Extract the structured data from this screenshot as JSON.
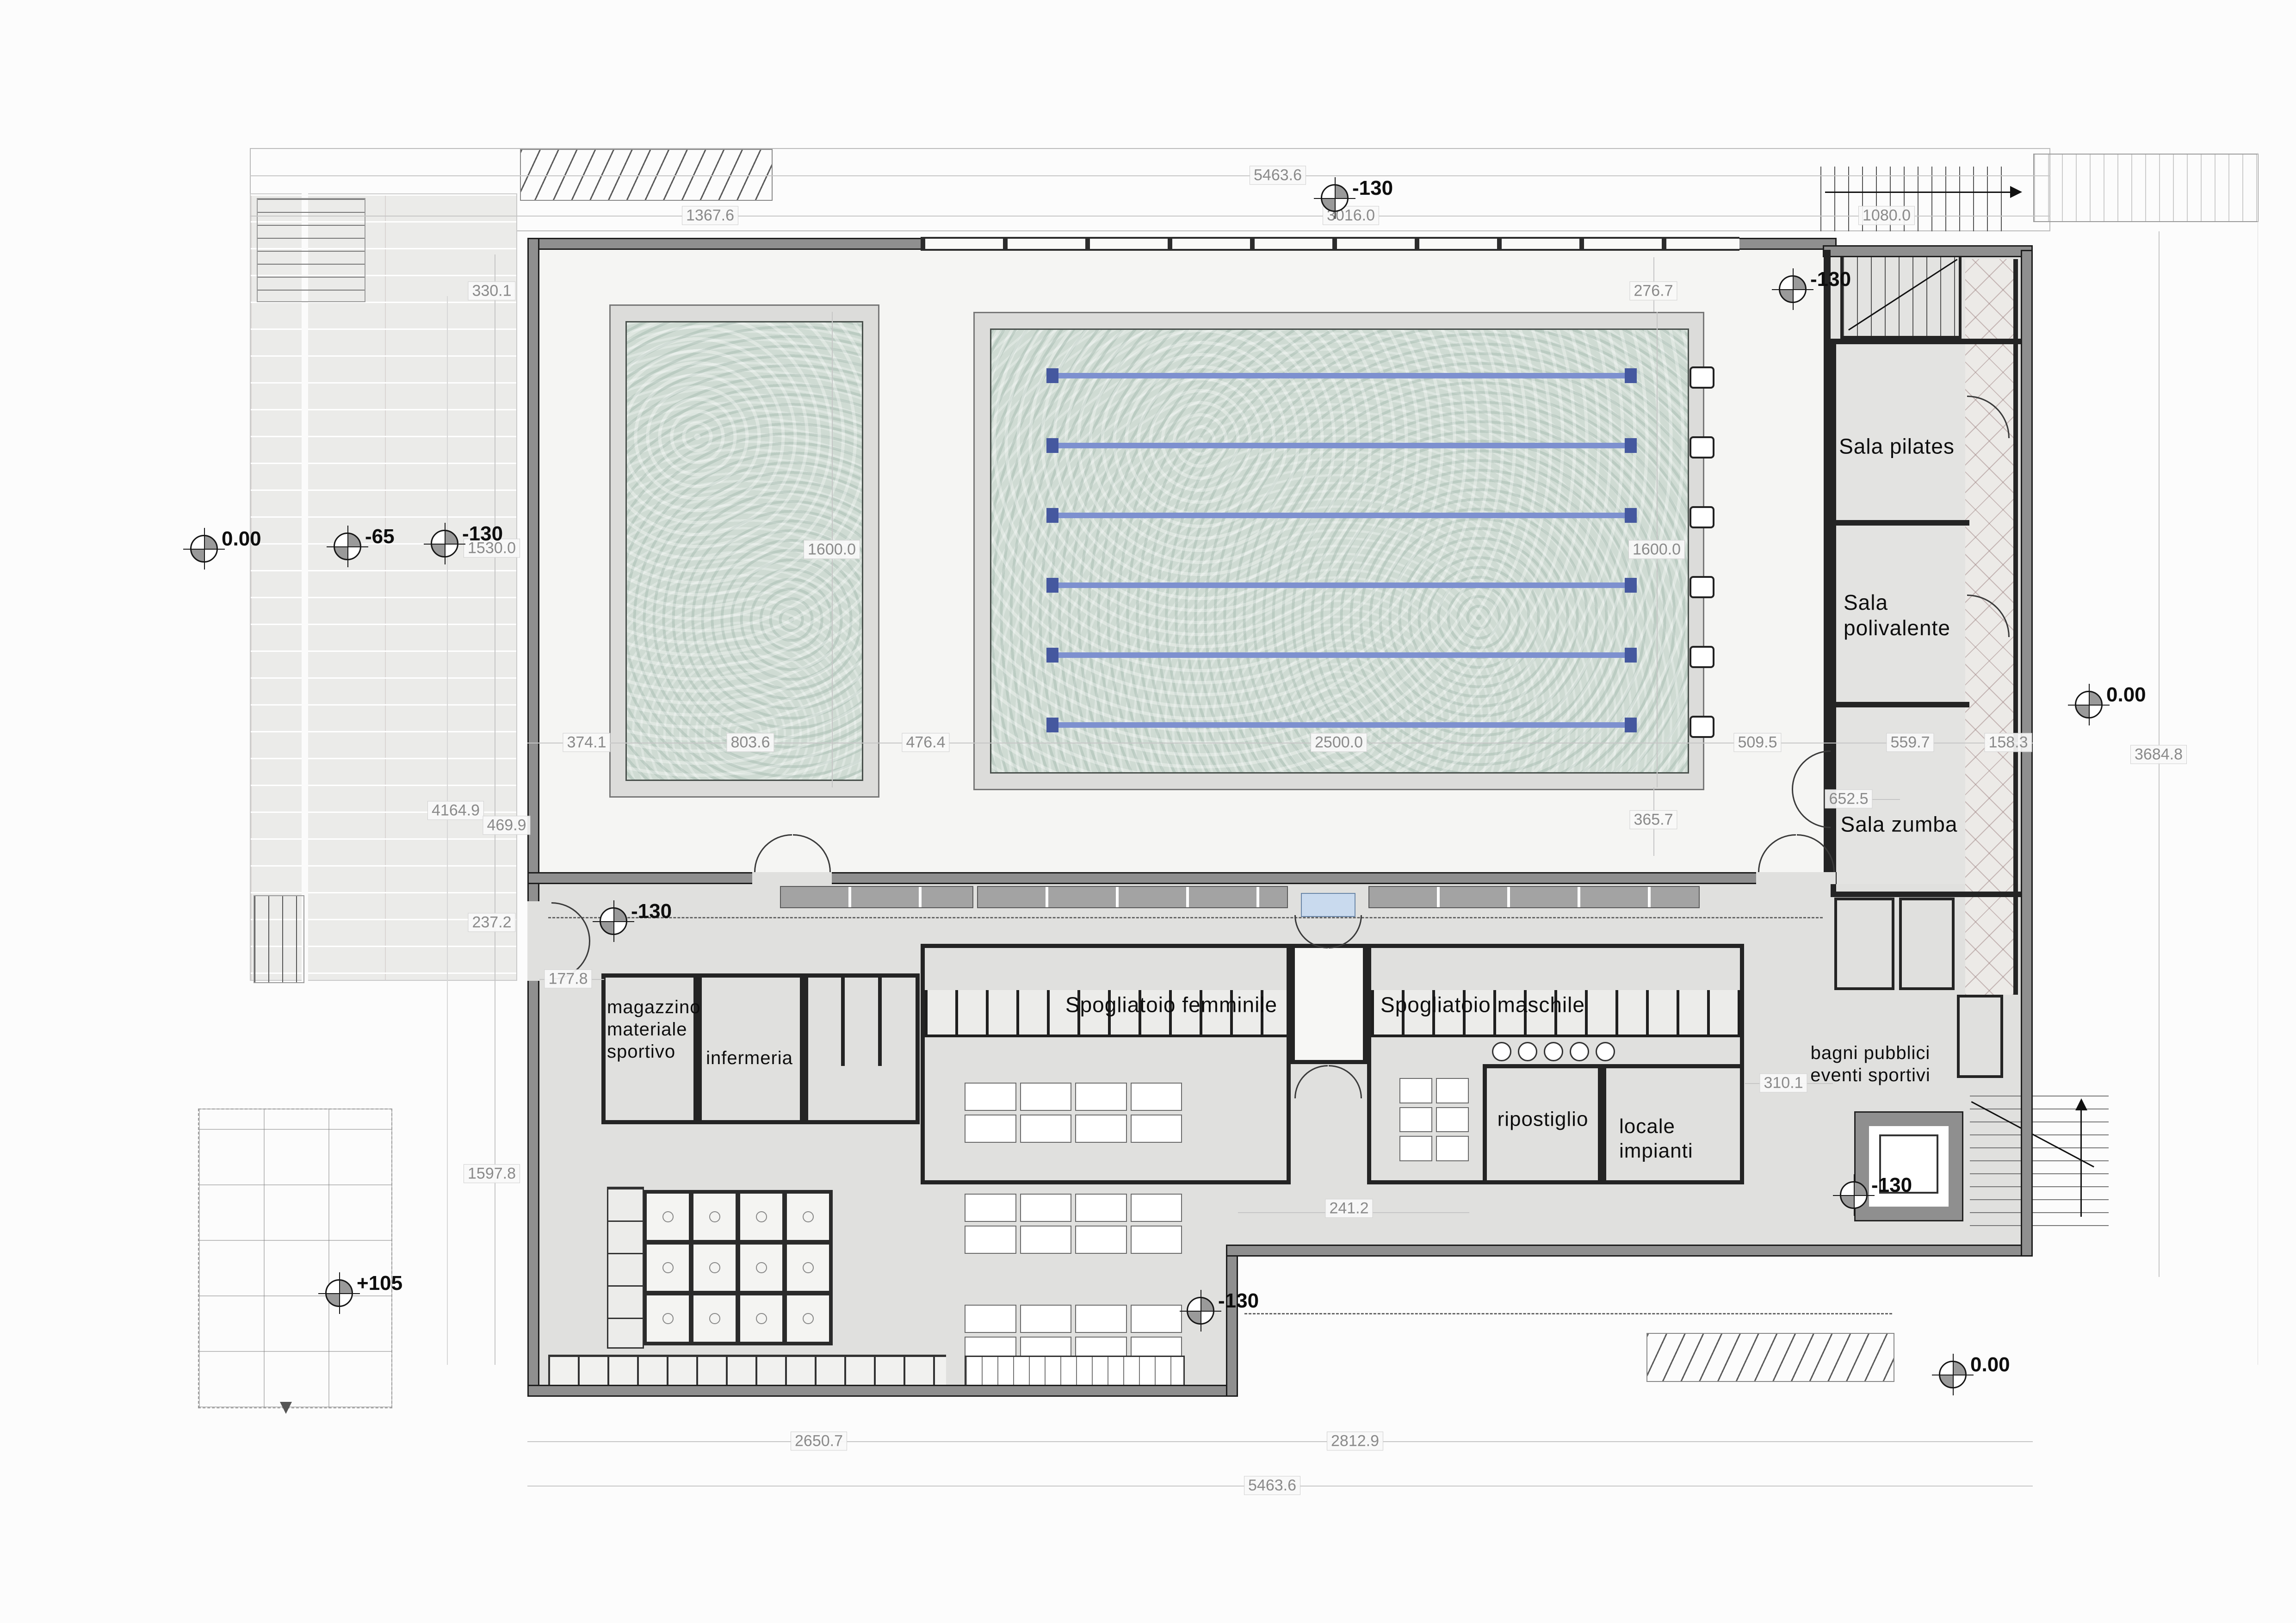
{
  "drawing": {
    "type": "architectural floor plan",
    "subject": "swimming pool sports facility"
  },
  "rooms": {
    "sala_pilates": "Sala pilates",
    "sala_polivalente": "Sala\npolivalente",
    "sala_zumba": "Sala zumba",
    "spogliatoio_femminile": "Spogliatoio femminile",
    "spogliatoio_maschile": "Spogliatoio maschile",
    "magazzino": "magazzino\nmateriale\nsportivo",
    "infermeria": "infermeria",
    "ripostiglio": "ripostiglio",
    "locale_impianti": "locale\nimpianti",
    "bagni_pubblici": "bagni pubblici\neventi sportivi"
  },
  "dimensions": {
    "top_total": "5463.6",
    "top_mid": "3016.0",
    "top_left": "1367.6",
    "top_right": "1080.0",
    "left_330": "330.1",
    "left_1530": "1530.0",
    "left_4164": "4164.9",
    "left_469": "469.9",
    "left_237": "237.2",
    "left_177": "177.8",
    "left_1597": "1597.8",
    "pools_374": "374.1",
    "pools_803": "803.6",
    "pools_476": "476.4",
    "pools_2500": "2500.0",
    "pools_509": "509.5",
    "pools_559": "559.7",
    "pools_158": "158.3",
    "pool_small_len": "1600.0",
    "pool_big_len": "1600.0",
    "right_276": "276.7",
    "right_365": "365.7",
    "right_652": "652.5",
    "right_total": "3684.8",
    "mid_241": "241.2",
    "mid_310": "310.1",
    "bottom_left": "2650.7",
    "bottom_right": "2812.9",
    "bottom_total": "5463.6"
  },
  "levels": [
    {
      "id": "north-core",
      "label": "-130"
    },
    {
      "id": "north-east",
      "label": "-130"
    },
    {
      "id": "west-plaza",
      "label": "0.00"
    },
    {
      "id": "west-deck",
      "label": "-65"
    },
    {
      "id": "west-poolside",
      "label": "-130"
    },
    {
      "id": "east-entry",
      "label": "0.00"
    },
    {
      "id": "west-entrance-hall",
      "label": "-130"
    },
    {
      "id": "south-plaza",
      "label": "+105"
    },
    {
      "id": "south-hall",
      "label": "-130"
    },
    {
      "id": "stair-core",
      "label": "-130"
    },
    {
      "id": "south-east",
      "label": "0.00"
    }
  ],
  "colors": {
    "wall_fill": "#8f8f8f",
    "wall_edge": "#1d1d1d",
    "water": "#cfdbd3",
    "lane_rope": "#7d90cf",
    "lane_cap": "#45589f",
    "hall_floor": "#f5f5f3",
    "service_floor": "#e0e0de",
    "deck": "#ebebe9",
    "footbath": "#c9daee",
    "dim_text": "#8a8a8a"
  }
}
